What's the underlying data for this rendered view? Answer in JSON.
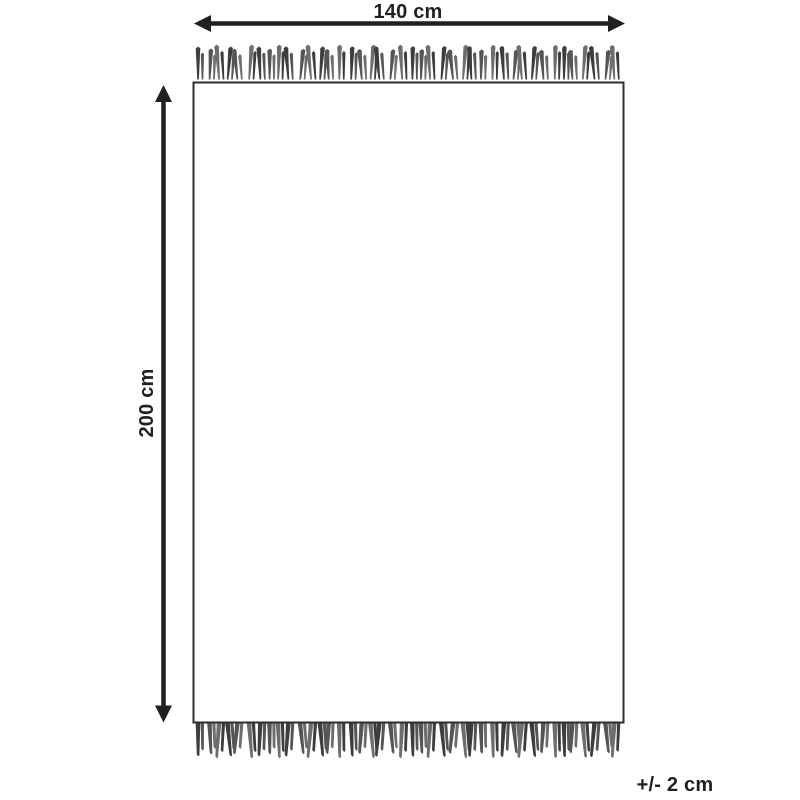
{
  "diagram": {
    "width_label": "140 cm",
    "height_label": "200 cm",
    "tolerance_label": "+/- 2 cm",
    "colors": {
      "ink": "#231f20",
      "outline": "#2e2e2e",
      "fringe": [
        "#3d3d3d",
        "#555555",
        "#6d6d6d"
      ]
    },
    "icons": {
      "width_arrow": "double-headed-horizontal-arrow-icon",
      "height_arrow": "double-headed-vertical-arrow-icon"
    }
  }
}
